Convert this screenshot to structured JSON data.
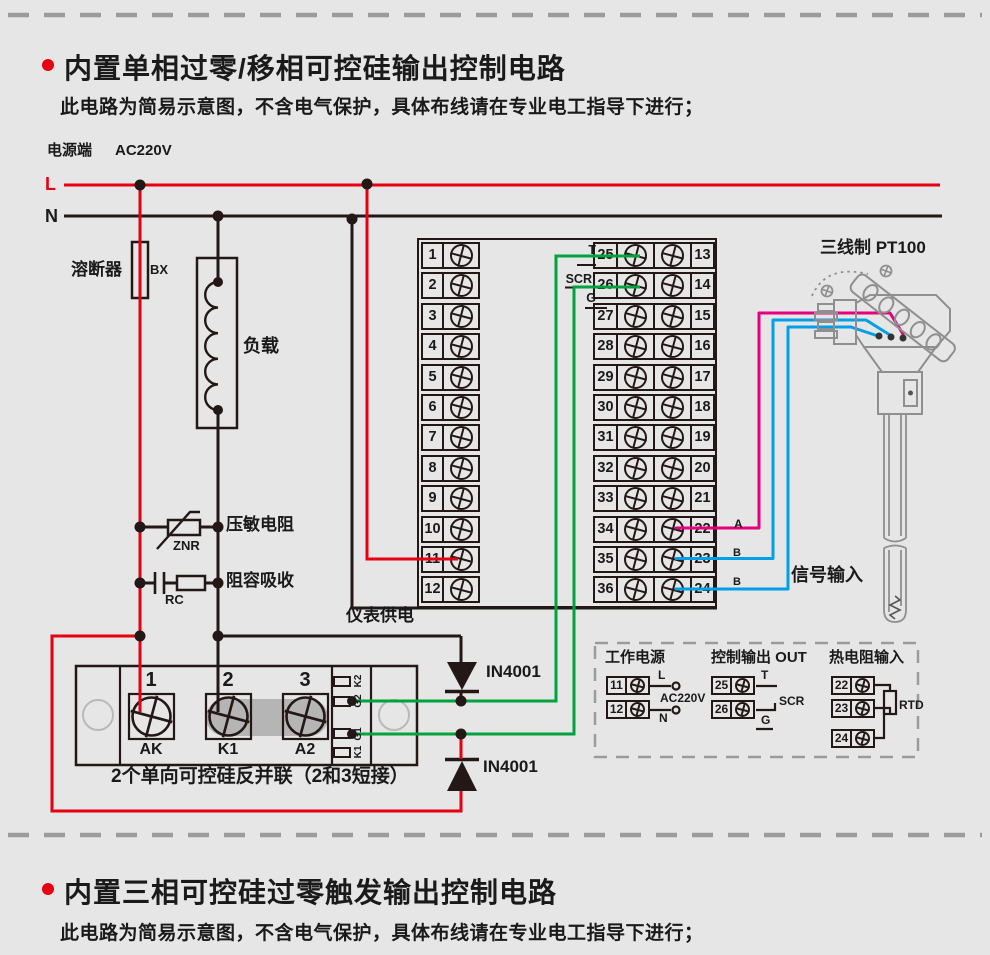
{
  "colors": {
    "red": "#e60012",
    "green": "#00a33e",
    "pink": "#e4007f",
    "blue": "#00a0e9",
    "ink": "#231815"
  },
  "section1": {
    "title": "内置单相过零/移相可控硅输出控制电路",
    "subtitle": "此电路为简易示意图，不含电气保护，具体布线请在专业电工指导下进行；"
  },
  "section2": {
    "title": "内置三相可控硅过零触发输出控制电路",
    "subtitle": "此电路为简易示意图，不含电气保护，具体布线请在专业电工指导下进行；"
  },
  "power": {
    "source_label": "电源端",
    "voltage": "AC220V",
    "live": "L",
    "neutral": "N"
  },
  "components": {
    "fuse_label": "溶断器",
    "fuse_code": "BX",
    "load_label": "负载",
    "varistor_label": "压敏电阻",
    "varistor_code": "ZNR",
    "snubber_label": "阻容吸收",
    "snubber_code": "RC",
    "diode_top": "IN4001",
    "diode_bottom": "IN4001"
  },
  "instrument": {
    "supply_label": "仪表供电",
    "t_label": "T",
    "scr_label": "SCR",
    "g_label": "G",
    "left_terminals": [
      "1",
      "2",
      "3",
      "4",
      "5",
      "6",
      "7",
      "8",
      "9",
      "10",
      "11",
      "12"
    ],
    "mid_terminals": [
      "25",
      "26",
      "27",
      "28",
      "29",
      "30",
      "31",
      "32",
      "33",
      "34",
      "35",
      "36"
    ],
    "right_terminals": [
      "13",
      "14",
      "15",
      "16",
      "17",
      "18",
      "19",
      "20",
      "21",
      "22",
      "23",
      "24"
    ]
  },
  "scr_module": {
    "terminal_numbers": [
      "1",
      "2",
      "3"
    ],
    "terminal_names": [
      "AK",
      "K1",
      "A2"
    ],
    "slot_labels": [
      "K2",
      "G2",
      "G1",
      "K1"
    ],
    "caption": "2个单向可控硅反并联（2和3短接）"
  },
  "sensor": {
    "title": "三线制 PT100",
    "wire_a": "A",
    "wire_b1": "B",
    "wire_b2": "B",
    "signal_label": "信号输入"
  },
  "info_box": {
    "power": {
      "title": "工作电源",
      "terminals": [
        "11",
        "12"
      ],
      "live": "L",
      "voltage": "AC220V",
      "neutral": "N"
    },
    "output": {
      "title": "控制输出 OUT",
      "terminals": [
        "25",
        "26"
      ],
      "t": "T",
      "scr": "SCR",
      "g": "G"
    },
    "rtd": {
      "title": "热电阻输入",
      "terminals": [
        "22",
        "23",
        "24"
      ],
      "label": "RTD"
    }
  }
}
